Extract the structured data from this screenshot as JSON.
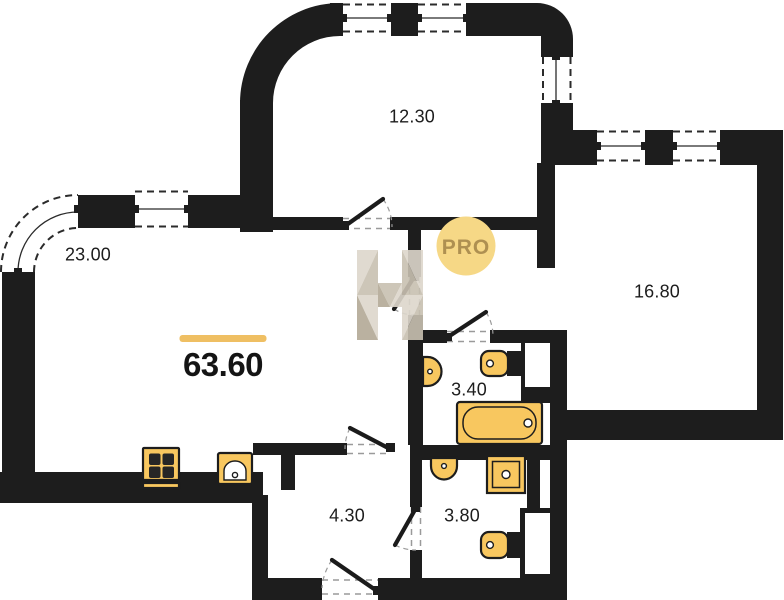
{
  "plan": {
    "total_area": "63.60",
    "rooms": [
      {
        "id": "living-room",
        "area": "23.00"
      },
      {
        "id": "bedroom",
        "area": "12.30"
      },
      {
        "id": "bedroom-2",
        "area": "16.80"
      },
      {
        "id": "bathroom",
        "area": "3.40"
      },
      {
        "id": "hallway",
        "area": "4.30"
      },
      {
        "id": "wc",
        "area": "3.80"
      }
    ],
    "badge": {
      "label": "PRO"
    },
    "colors": {
      "wall": "#1d1d1d",
      "fixture_fill": "#f8c75f",
      "fixture_fill_light": "#fbd988",
      "accent_bar": "#efbf63",
      "badge_bg": "#f6d886",
      "badge_text": "#ae9051",
      "watermark_beige_1": "#ddd7cc",
      "watermark_beige_2": "#c8c0b1",
      "watermark_beige_3": "#b3a996",
      "label_color": "#1d1d1d"
    }
  }
}
